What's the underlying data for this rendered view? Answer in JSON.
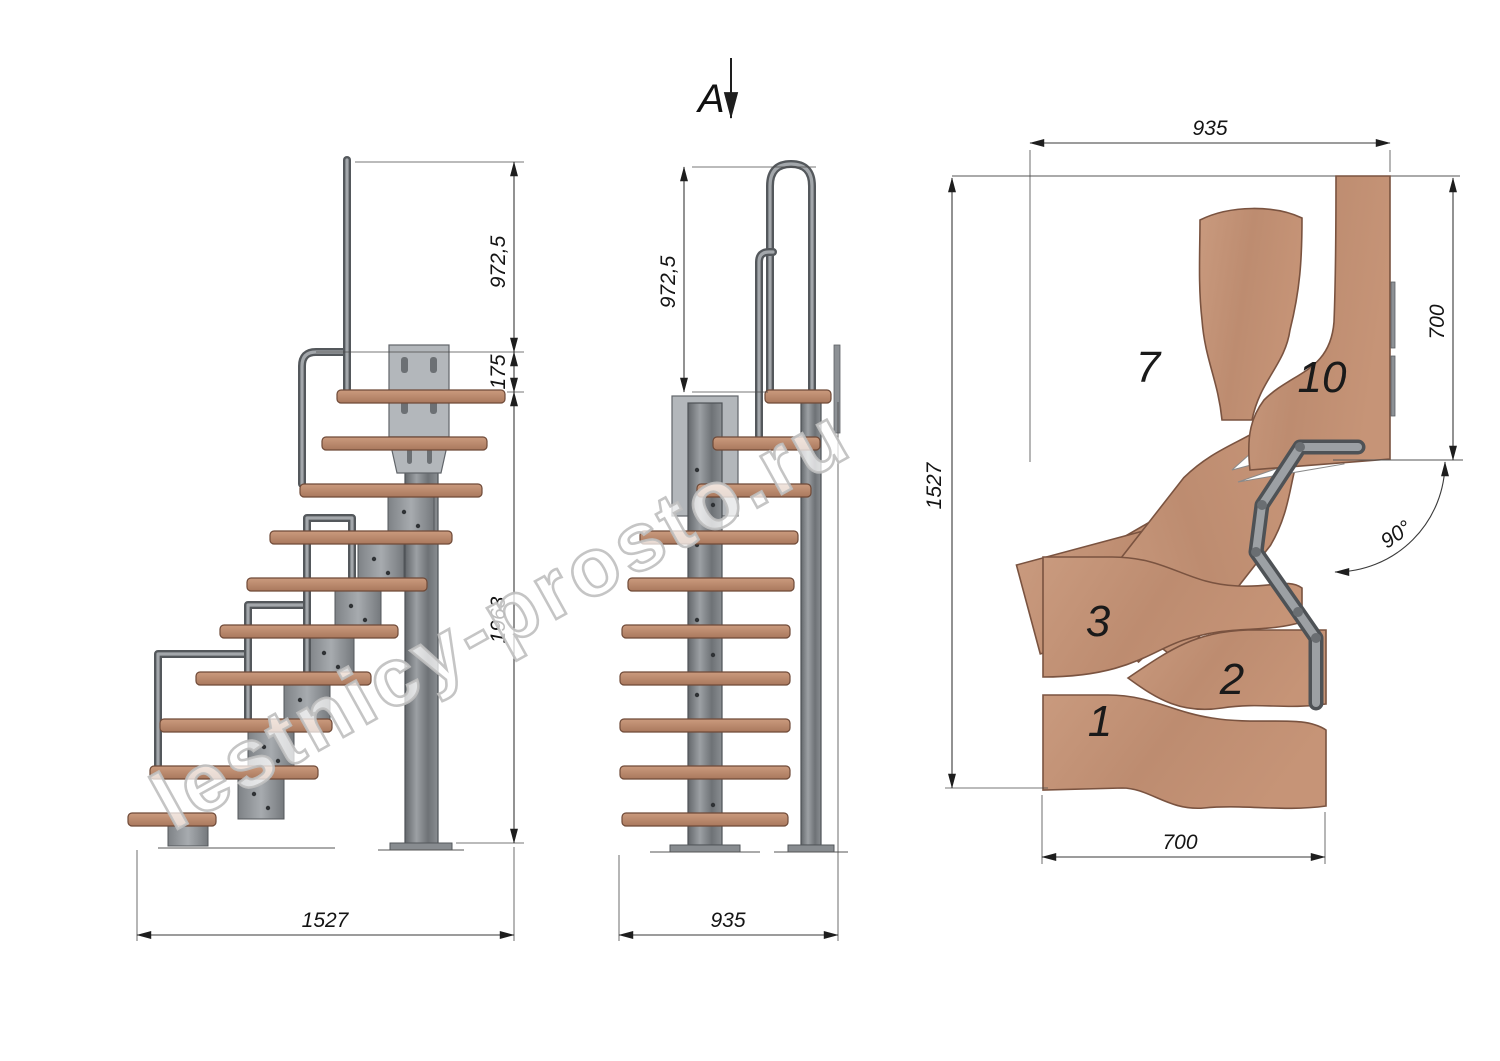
{
  "watermark": "lestnicy-prosto.ru",
  "section_view": {
    "label": "A"
  },
  "side_view": {
    "dimensions": {
      "handrail_height": "972,5",
      "landing_offset": "175",
      "height_to_platform": "1963",
      "total_run": "1527"
    }
  },
  "front_view": {
    "dimensions": {
      "handrail_height": "972,5",
      "width": "935"
    }
  },
  "plan_view": {
    "dimensions": {
      "width": "935",
      "landing_depth": "700",
      "total_depth": "1527",
      "bottom_width": "700",
      "turn_angle": "90°"
    },
    "treads": [
      {
        "label": "1"
      },
      {
        "label": "2"
      },
      {
        "label": "3"
      },
      {
        "label": "7"
      },
      {
        "label": "10"
      }
    ]
  },
  "colors": {
    "wood": "#c49478",
    "wood_edge": "#7a5340",
    "metal": "#8f9397",
    "metal_dark": "#54585c",
    "line": "#3a3a3a"
  }
}
